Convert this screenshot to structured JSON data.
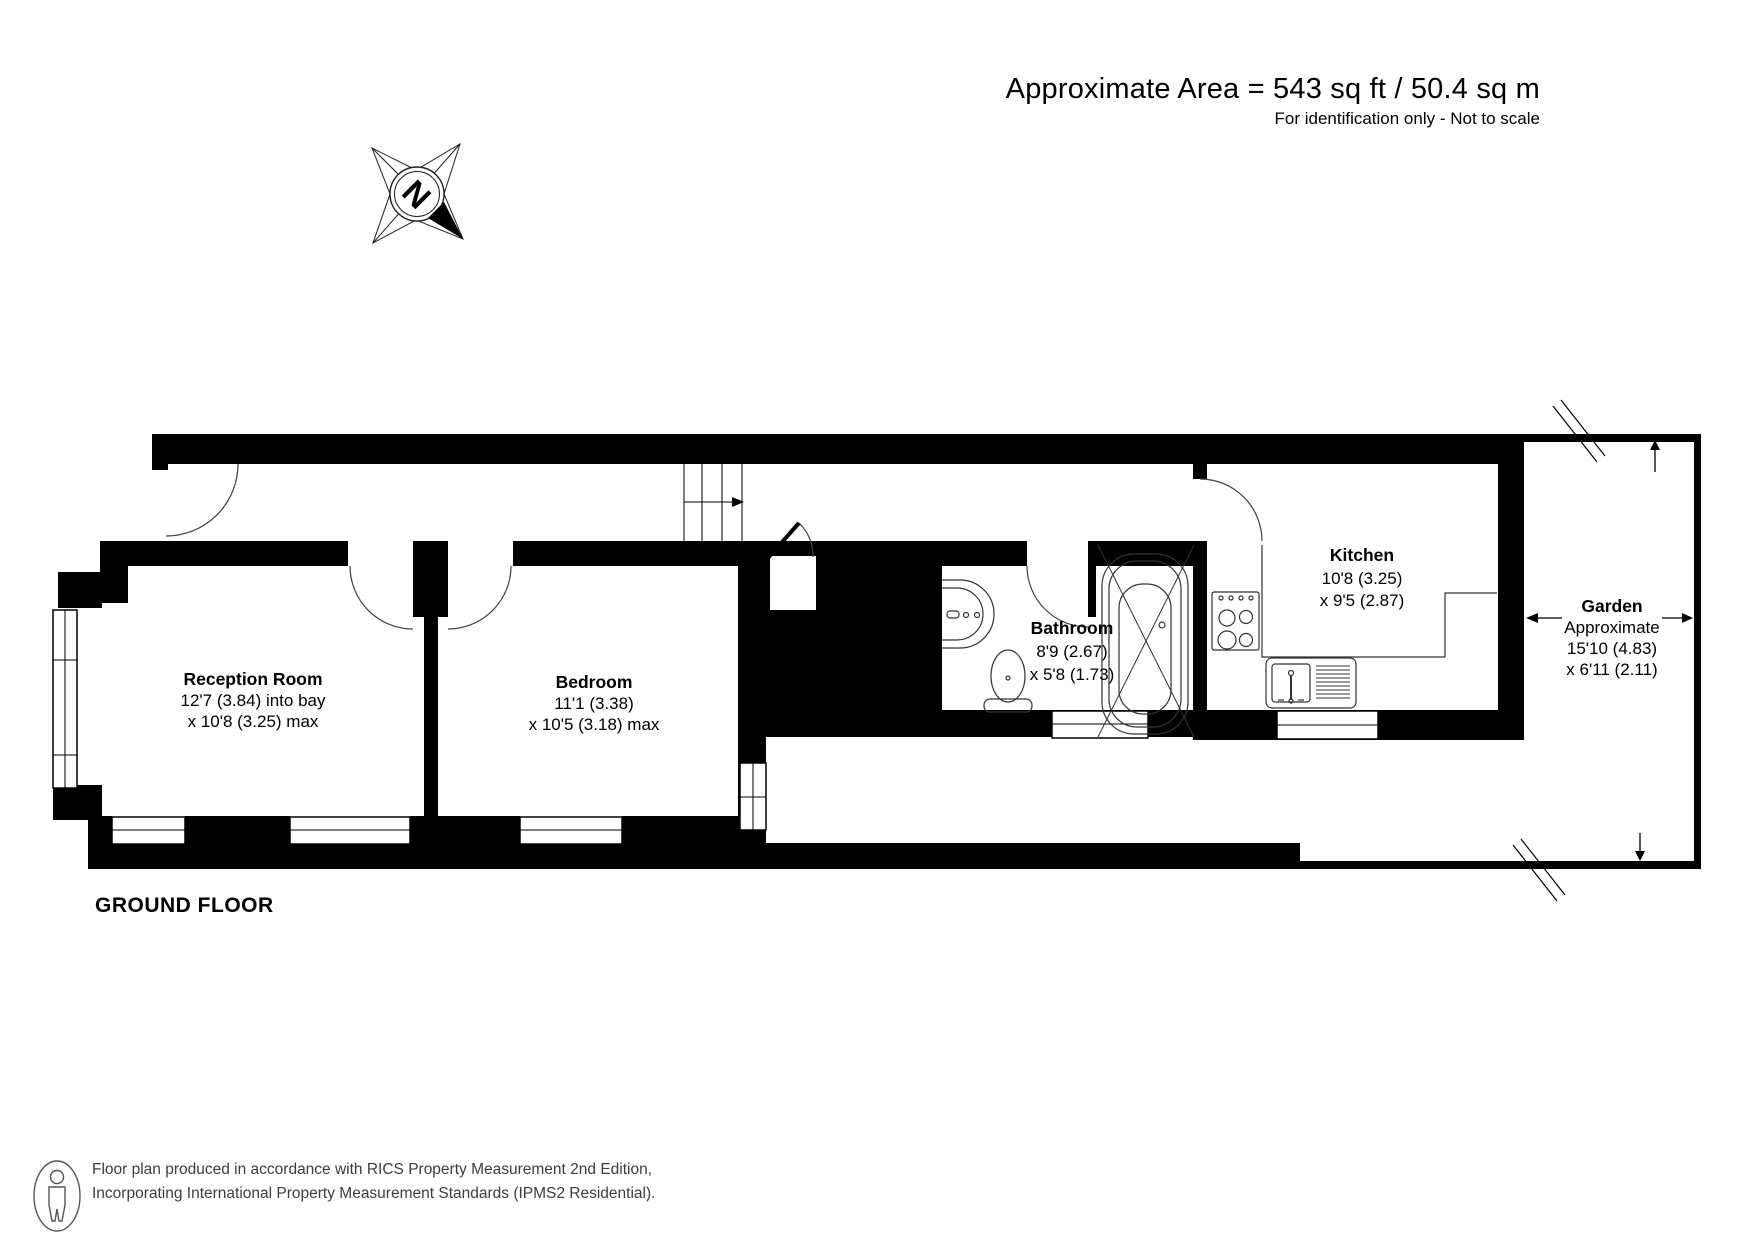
{
  "header": {
    "title": "Approximate Area = 543 sq ft / 50.4 sq m",
    "subtitle": "For identification only - Not to scale"
  },
  "compass": {
    "north_label": "N"
  },
  "plan": {
    "floor_label": "GROUND FLOOR"
  },
  "rooms": [
    {
      "name": "Reception Room",
      "dim_line1": "12'7 (3.84) into bay",
      "dim_line2": "x 10'8 (3.25) max"
    },
    {
      "name": "Bedroom",
      "dim_line1": "11'1 (3.38)",
      "dim_line2": "x 10'5 (3.18) max"
    },
    {
      "name": "Bathroom",
      "dim_line1": "8'9 (2.67)",
      "dim_line2": "x 5'8 (1.73)"
    },
    {
      "name": "Kitchen",
      "dim_line1": "10'8 (3.25)",
      "dim_line2": "x 9'5 (2.87)"
    },
    {
      "name": "Garden",
      "note": "Approximate",
      "dim_line1": "15'10 (4.83)",
      "dim_line2": "x 6'11 (2.11)"
    }
  ],
  "footer": {
    "line1": "Floor plan produced in accordance with RICS Property Measurement 2nd Edition,",
    "line2": "Incorporating International Property Measurement Standards (IPMS2 Residential)."
  },
  "colors": {
    "wall": "#000000",
    "footer_text": "#3d3d3d"
  }
}
